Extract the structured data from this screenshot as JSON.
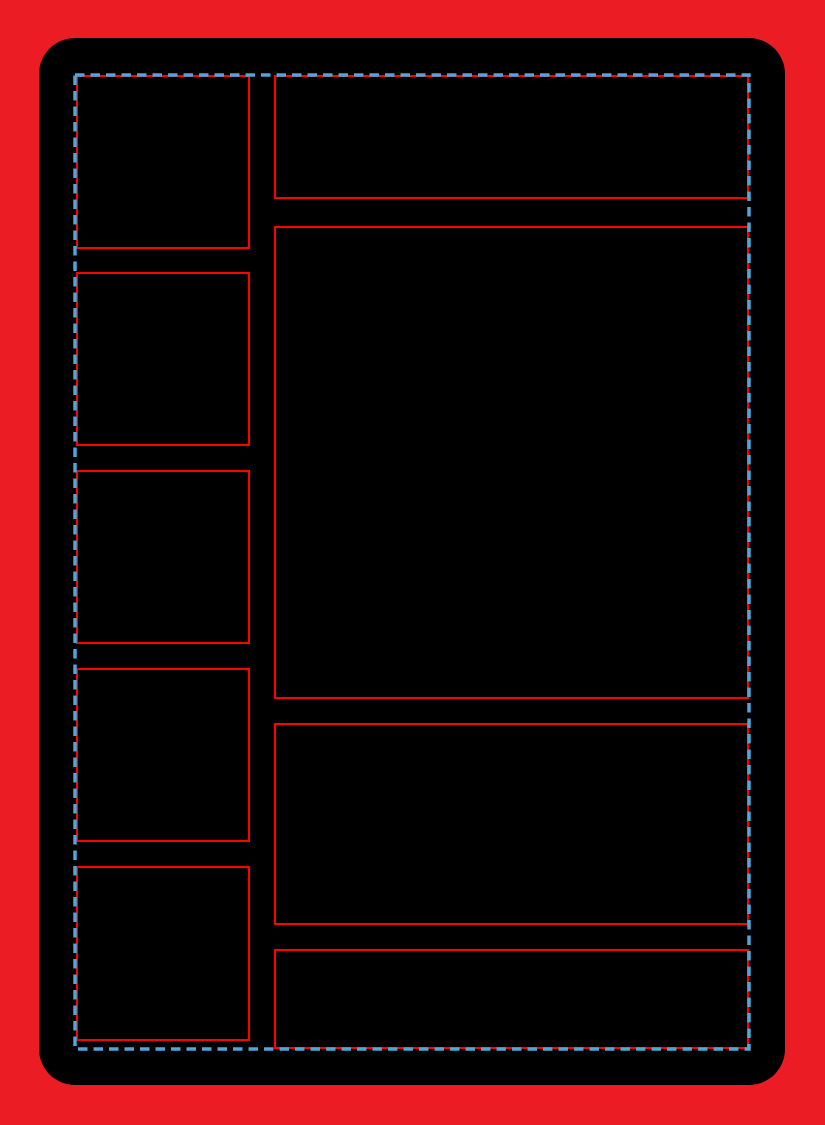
{
  "title": "Blank trading card layout template",
  "canvas": {
    "width": 825,
    "height": 1125,
    "background_color": "#EC1C24"
  },
  "card": {
    "x": 39,
    "y": 38,
    "width": 746,
    "height": 1047,
    "corner_radius": 36,
    "fill_color": "#000000"
  },
  "guide_border": {
    "style": "dashed",
    "color": "#4FA6DB",
    "x": 75,
    "y": 75,
    "width": 674,
    "height": 974,
    "stroke_width": 3.5,
    "dash_length": 9.5,
    "gap_length": 6
  },
  "frame_style": {
    "border_color": "#FF0000",
    "border_width": 2,
    "fill_color": "#000000"
  },
  "frames": [
    {
      "name": "left-frame-1",
      "column": "left",
      "x": 76,
      "y": 75,
      "width": 174,
      "height": 174
    },
    {
      "name": "left-frame-2",
      "column": "left",
      "x": 76,
      "y": 272,
      "width": 174,
      "height": 174
    },
    {
      "name": "left-frame-3",
      "column": "left",
      "x": 76,
      "y": 470,
      "width": 174,
      "height": 174
    },
    {
      "name": "left-frame-4",
      "column": "left",
      "x": 76,
      "y": 668,
      "width": 174,
      "height": 174
    },
    {
      "name": "left-frame-5",
      "column": "left",
      "x": 76,
      "y": 866,
      "width": 174,
      "height": 175
    },
    {
      "name": "right-frame-top",
      "column": "right",
      "x": 274,
      "y": 75,
      "width": 475,
      "height": 124
    },
    {
      "name": "right-frame-large",
      "column": "right",
      "x": 274,
      "y": 226,
      "width": 475,
      "height": 473
    },
    {
      "name": "right-frame-middle",
      "column": "right",
      "x": 274,
      "y": 723,
      "width": 475,
      "height": 202
    },
    {
      "name": "right-frame-bottom",
      "column": "right",
      "x": 274,
      "y": 949,
      "width": 475,
      "height": 100
    }
  ]
}
